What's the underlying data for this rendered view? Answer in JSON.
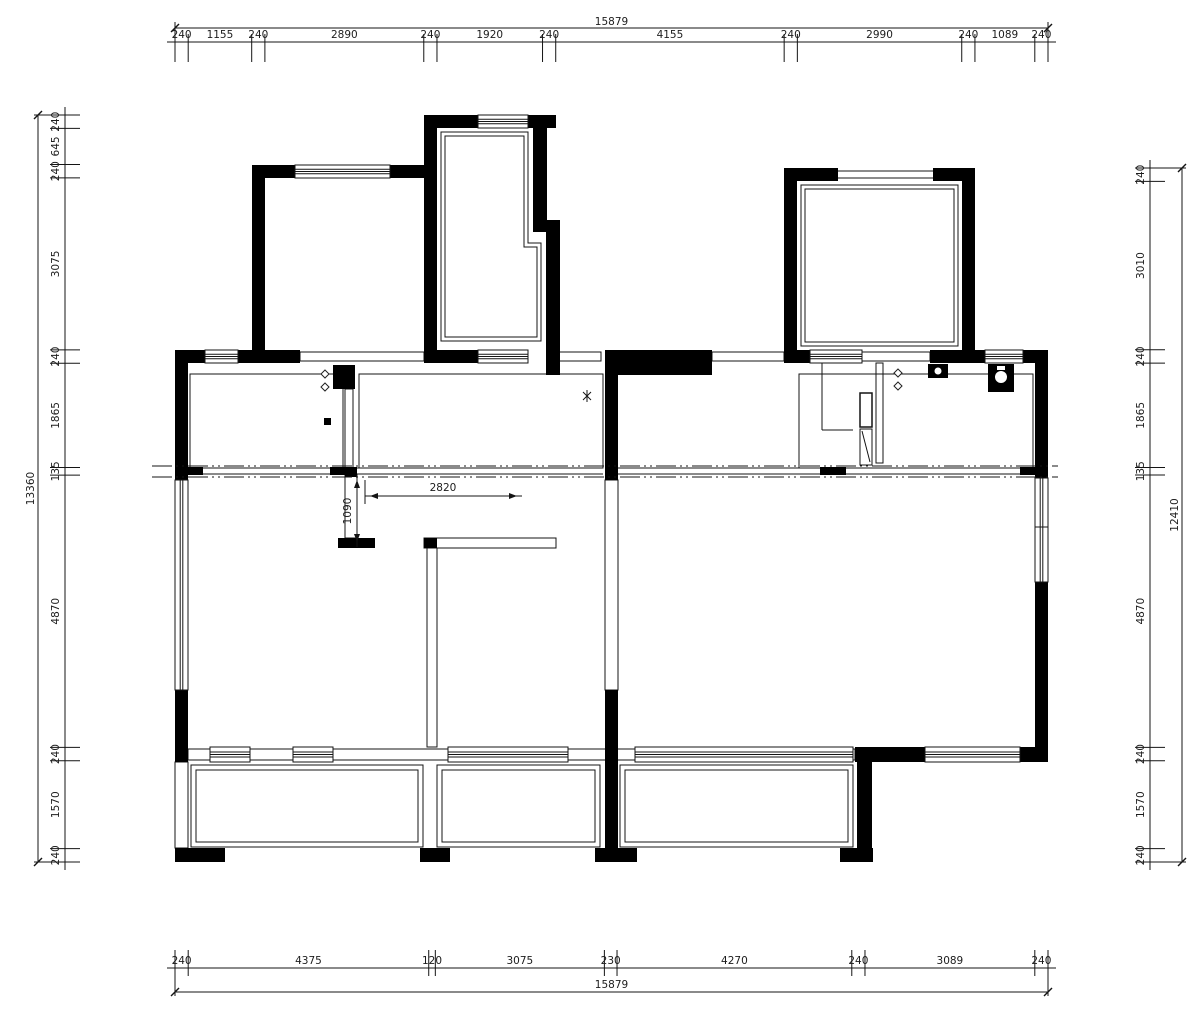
{
  "drawing": {
    "title": "floor-plan",
    "units": "mm",
    "colors": {
      "wall": "#000000",
      "line": "#141414",
      "text": "#1c1c1c",
      "background": "#ffffff"
    },
    "dimensions": {
      "top": {
        "overall": 15879,
        "segments": [
          240,
          1155,
          240,
          2890,
          240,
          1920,
          240,
          4155,
          240,
          2990,
          240,
          1089,
          240
        ]
      },
      "bottom": {
        "overall": 15879,
        "segments": [
          240,
          4375,
          120,
          3075,
          230,
          4270,
          240,
          3089,
          240
        ]
      },
      "left": {
        "overall": 13360,
        "segments": [
          240,
          645,
          240,
          3075,
          240,
          1865,
          135,
          4870,
          240,
          1570,
          240
        ]
      },
      "right": {
        "overall": 12410,
        "segments": [
          240,
          3010,
          240,
          1865,
          135,
          4870,
          240,
          1570,
          240
        ]
      },
      "interior": [
        {
          "label": 2820,
          "orientation": "horizontal"
        },
        {
          "label": 1090,
          "orientation": "vertical"
        }
      ]
    },
    "symbols": [
      "window-triple-line",
      "wall-solid",
      "axis-dash-dot-line",
      "diamond-marker",
      "outlet-square-marker",
      "asterisk-marker",
      "door-leaf",
      "sink-fixture",
      "toilet-fixture"
    ]
  }
}
